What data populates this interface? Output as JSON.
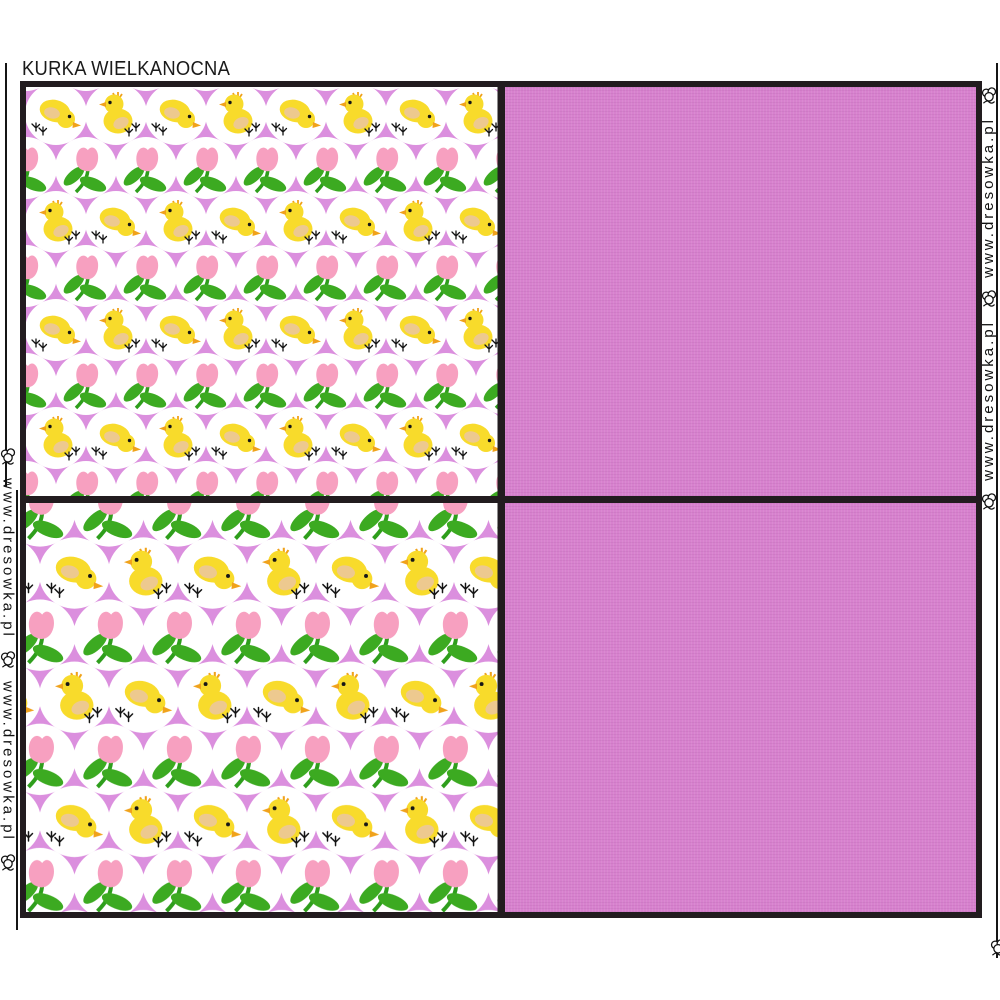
{
  "title": "KURKA WIELKANOCNA",
  "watermark": {
    "url_text": "www.dresowka.pl",
    "icon": "cotton-flower-icon"
  },
  "panels": {
    "layout": "2x2 grid with black borders",
    "top_left": {
      "type": "pattern",
      "motifs": [
        "yellow chick pecking",
        "yellow chick sitting",
        "pink tulip with green leaves"
      ],
      "background": "white circles on violet",
      "scale": "small"
    },
    "top_right": {
      "type": "solid",
      "description": "plain orchid-pink linen"
    },
    "bottom_left": {
      "type": "pattern",
      "motifs": [
        "yellow chick pecking",
        "yellow chick sitting",
        "pink tulip with green leaves"
      ],
      "background": "white circles on violet",
      "scale": "large"
    },
    "bottom_right": {
      "type": "solid",
      "description": "plain orchid-pink linen"
    }
  },
  "colors": {
    "pattern_background": "#DB8FDE",
    "solid_panel": "#D781CE",
    "circle_white": "#FFFFFF",
    "chick_yellow": "#F8DB2B",
    "chick_wing": "#EDC98F",
    "beak_orange": "#F0A21B",
    "tulip_pink": "#F7A0C0",
    "leaf_green": "#3CAA21",
    "border_black": "#221C1F",
    "text_black": "#161616"
  }
}
